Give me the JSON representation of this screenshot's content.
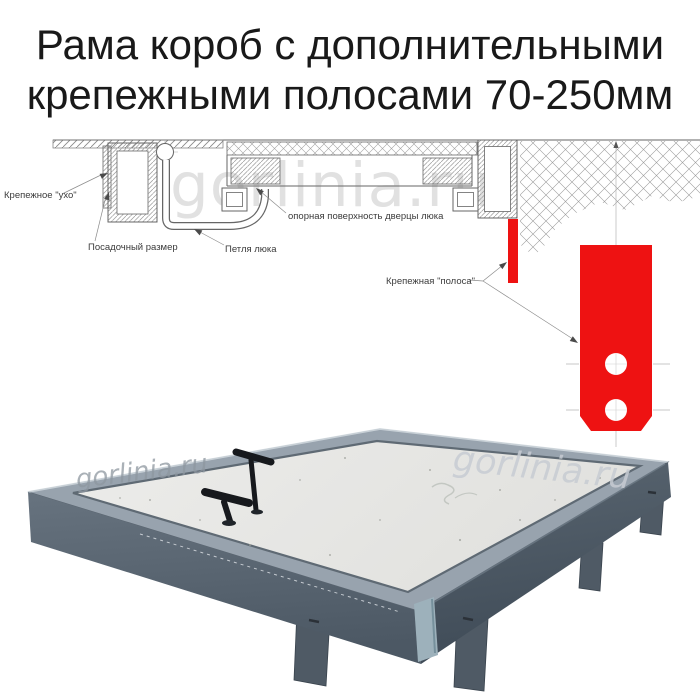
{
  "title": {
    "line1": "Рама короб с дополнительными",
    "line2": "крепежными полосами 70-250мм"
  },
  "watermark": {
    "text": "gorlinia.ru"
  },
  "diagram": {
    "labels": {
      "ear": "Крепежное \"ухо\"",
      "mount_size": "Посадочный размер",
      "hinge": "Петля люка",
      "support": "опорная поверхность дверцы люка",
      "strip": "Крепежная \"полоса\""
    },
    "colors": {
      "strip_red": "#ee1212",
      "line": "#6b6b6b",
      "label_text": "#3b3b3b",
      "watermark": "#e1e1e1"
    }
  },
  "photo": {
    "colors": {
      "rim": "#98a3ae",
      "panel": "#eaeae7",
      "face_left_top": "#67737f",
      "face_left_bottom": "#4c5864",
      "face_right_top": "#5a6671",
      "face_right_bottom": "#3f4b57",
      "leg": "#4f5a65",
      "handle": "#17191d",
      "corner_opening": "#9db1bb",
      "watermark_left": "#8e97a0",
      "watermark_right": "#c7ccd3"
    }
  }
}
